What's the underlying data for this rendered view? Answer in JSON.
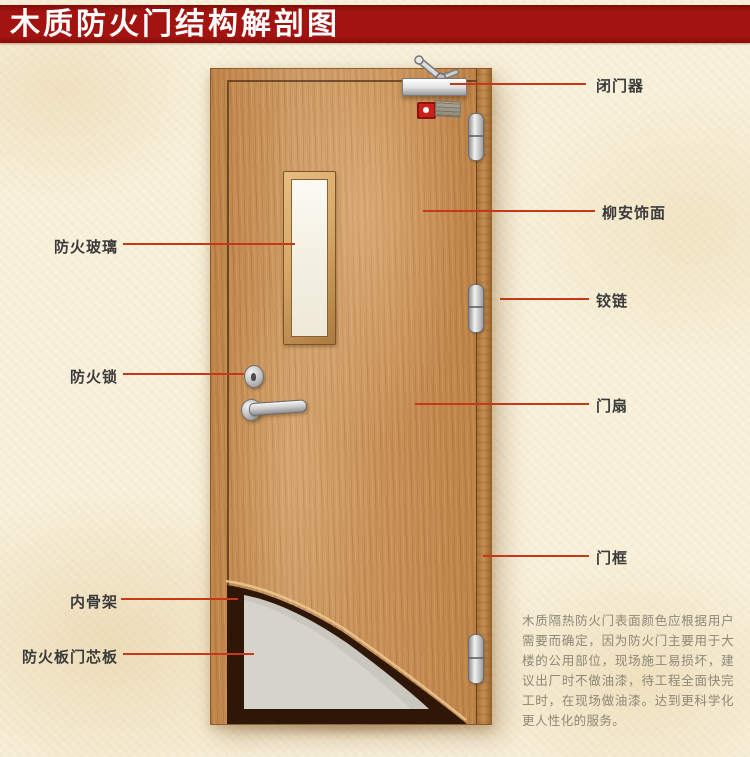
{
  "title": {
    "text": "木质防火门结构解剖图"
  },
  "callouts": {
    "left": [
      {
        "id": "fire-glass",
        "text": "防火玻璃"
      },
      {
        "id": "fire-lock",
        "text": "防火锁"
      },
      {
        "id": "inner-skeleton",
        "text": "内骨架"
      },
      {
        "id": "fire-board-core",
        "text": "防火板门芯板"
      }
    ],
    "right": [
      {
        "id": "door-closer",
        "text": "闭门器"
      },
      {
        "id": "lauan-veneer",
        "text": "柳安饰面"
      },
      {
        "id": "hinge",
        "text": "铰链"
      },
      {
        "id": "door-leaf",
        "text": "门扇"
      },
      {
        "id": "door-frame",
        "text": "门框"
      }
    ]
  },
  "description": {
    "text": "木质隔热防火门表面颜色应根据用户需要而确定，因为防火门主要用于大楼的公用部位，现场施工易损坏，建议出厂时不做油漆，待工程全面快完工时，在现场做油漆。达到更科学化更人性化的服务。"
  },
  "colors": {
    "banner_red": "#a31410",
    "leader_line": "#c63817",
    "wood": "#ca9158",
    "core_board": "#d5d3ca",
    "skeleton_dark": "#2f1707",
    "background": "#f8f0da",
    "label_text": "#3b3b3b",
    "description_text": "#8d8878"
  }
}
